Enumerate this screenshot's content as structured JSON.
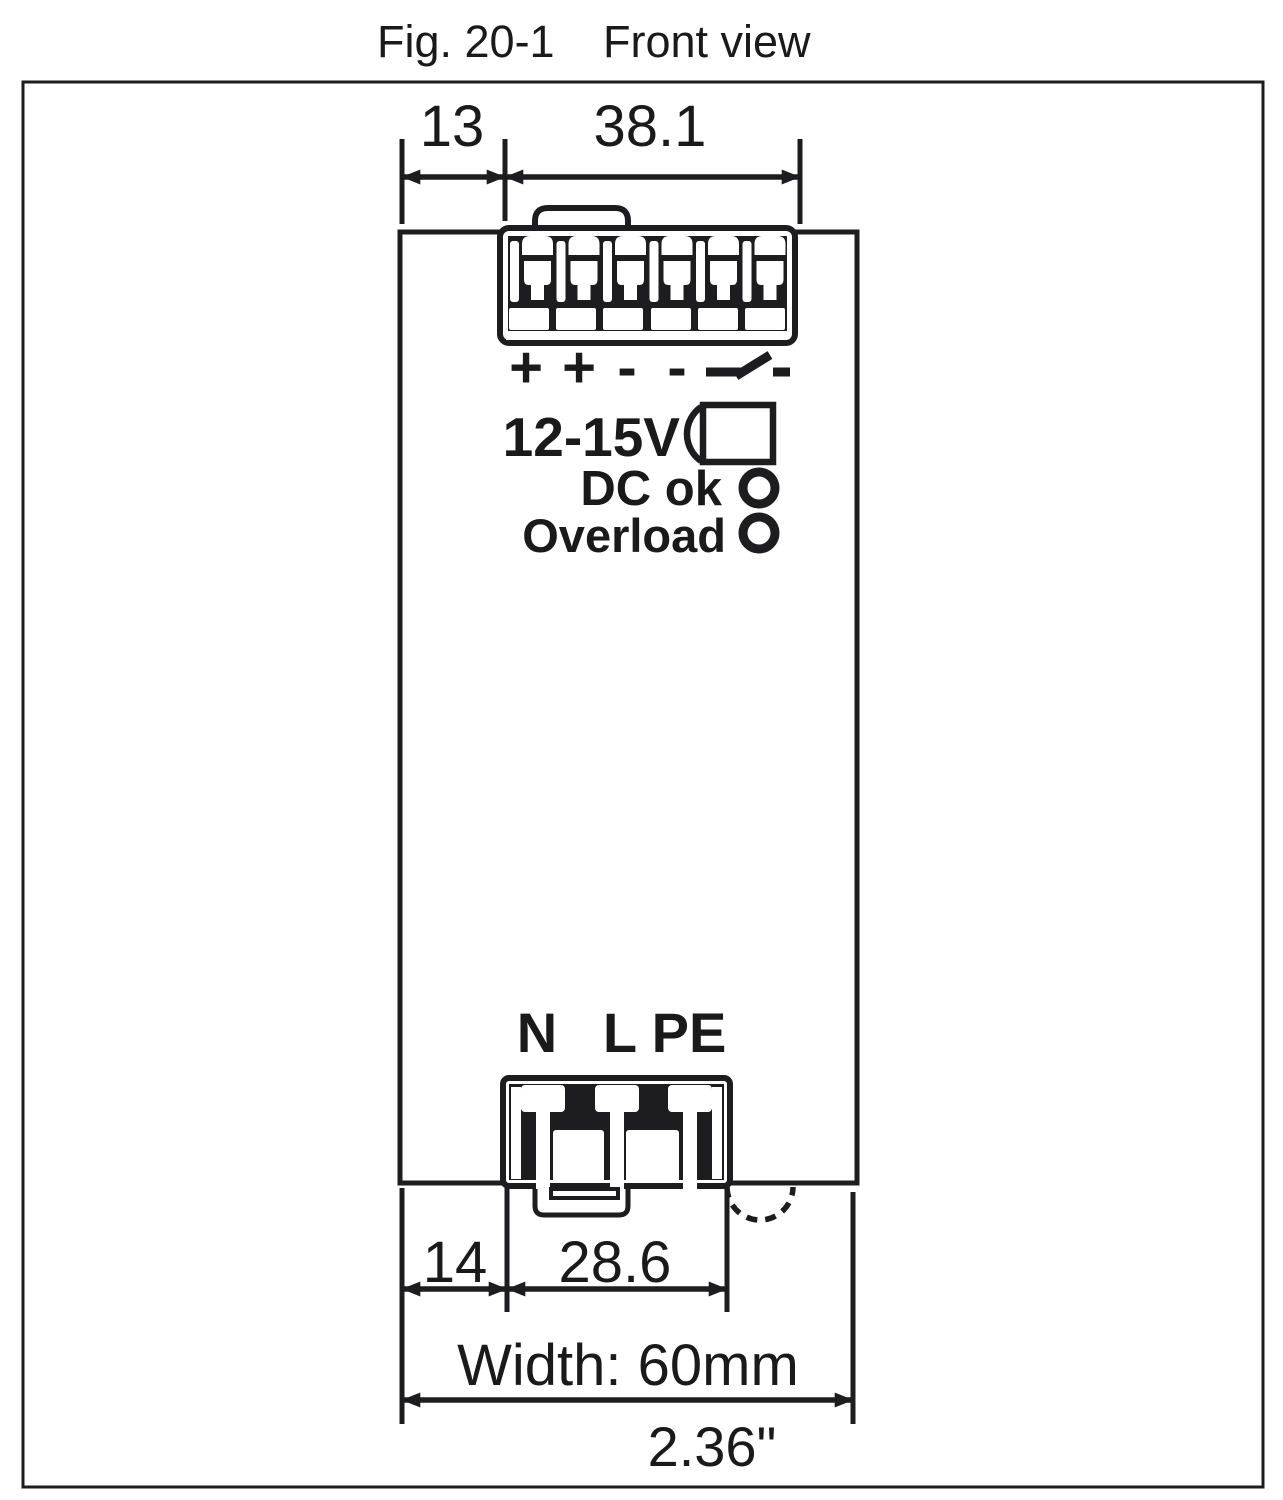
{
  "title": {
    "figure_label": "Fig. 20-1",
    "view_label": "Front view"
  },
  "device": {
    "polarity_symbols": [
      "+",
      "+",
      "-",
      "-"
    ],
    "voltage_range": "12-15V",
    "led_labels": {
      "dc_ok": "DC ok",
      "overload": "Overload"
    },
    "input_terminals": {
      "neutral": "N",
      "line": "L",
      "earth": "PE"
    }
  },
  "dimensions": {
    "top_offset": "13",
    "output_connector_width": "38.1",
    "bottom_offset": "14",
    "input_connector_width": "28.6",
    "overall_width_mm": "Width: 60mm",
    "overall_width_inches": "2.36\""
  },
  "colors": {
    "line": "#1d1d1f",
    "background": "#ffffff"
  }
}
